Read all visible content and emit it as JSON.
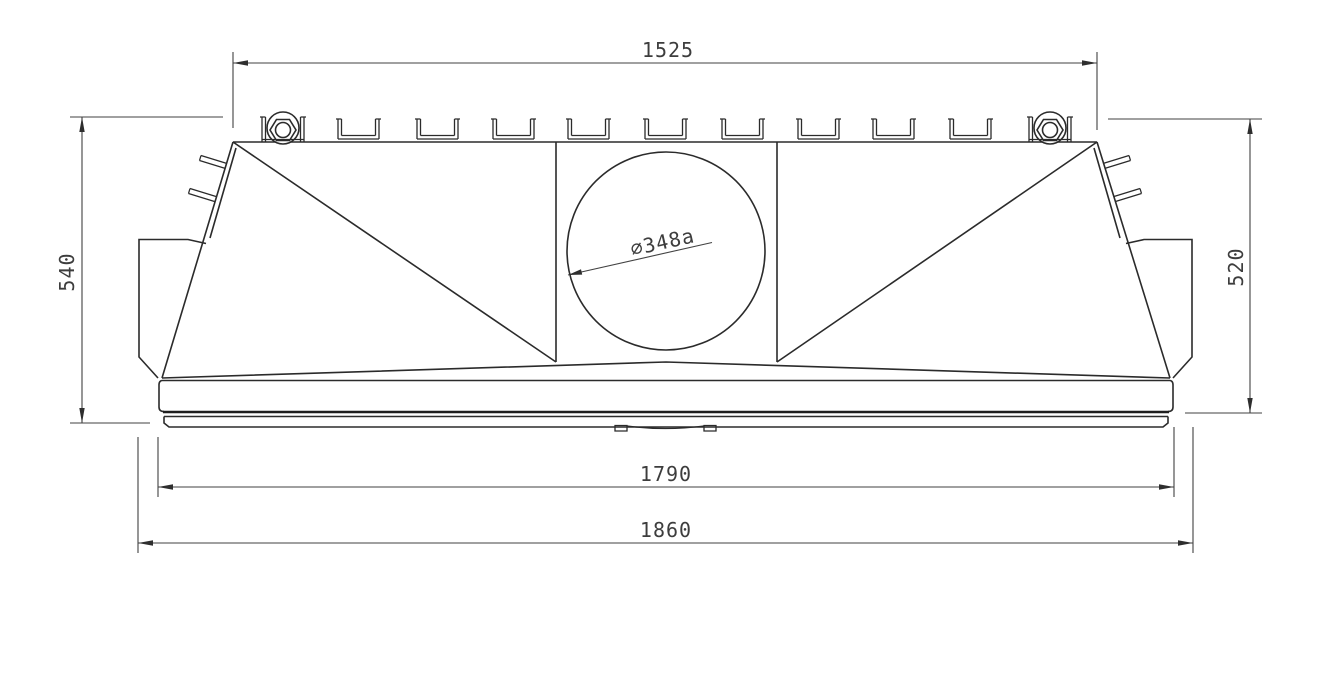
{
  "drawing": {
    "kind": "engineering-front-view",
    "colors": {
      "background": "#ffffff",
      "outline": "#2b2b2b",
      "dimension_lines": "#424242",
      "dimension_text": "#3d3d3d"
    },
    "dimensions": {
      "top_width": "1525",
      "left_height": "540",
      "right_height": "520",
      "base_width": "1790",
      "overall_width": "1860",
      "bore_diameter": "⌀348a"
    }
  }
}
